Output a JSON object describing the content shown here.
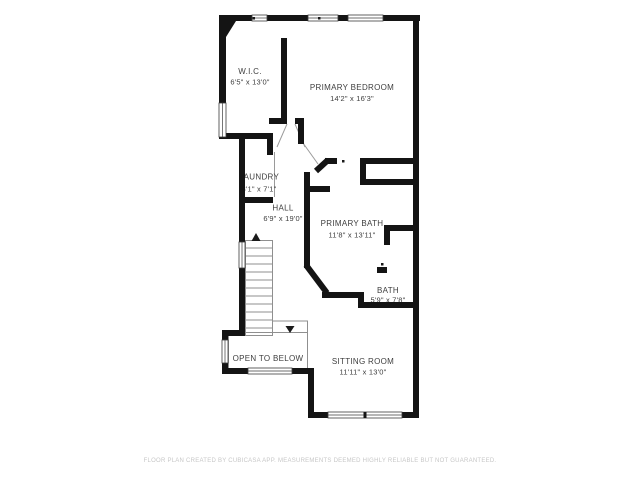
{
  "plan": {
    "type": "floor-plan",
    "rooms": [
      {
        "name": "W.I.C.",
        "dims": "6'5\" x 13'0\""
      },
      {
        "name": "PRIMARY BEDROOM",
        "dims": "14'2\" x 16'3\""
      },
      {
        "name": "LAUNDRY",
        "dims": "3'1\" x 7'1\""
      },
      {
        "name": "HALL",
        "dims": "6'9\" x 19'0\""
      },
      {
        "name": "PRIMARY BATH",
        "dims": "11'8\" x 13'11\""
      },
      {
        "name": "BATH",
        "dims": "5'9\" x 7'8\""
      },
      {
        "name": "SITTING ROOM",
        "dims": "11'11\" x 13'0\""
      },
      {
        "name": "OPEN TO BELOW",
        "dims": ""
      }
    ],
    "features": [
      "stairs-up-arrow",
      "stairs-down-arrow",
      "windows",
      "door-swings"
    ]
  },
  "colors": {
    "wall": "#141414",
    "room_text": "#3e3e3e",
    "thin_line": "#8f8f8f",
    "footer_text": "#c7c7c7",
    "background": "#ffffff"
  },
  "footer": {
    "text": "FLOOR PLAN CREATED BY CUBICASA APP. MEASUREMENTS DEEMED HIGHLY RELIABLE BUT NOT GUARANTEED."
  }
}
